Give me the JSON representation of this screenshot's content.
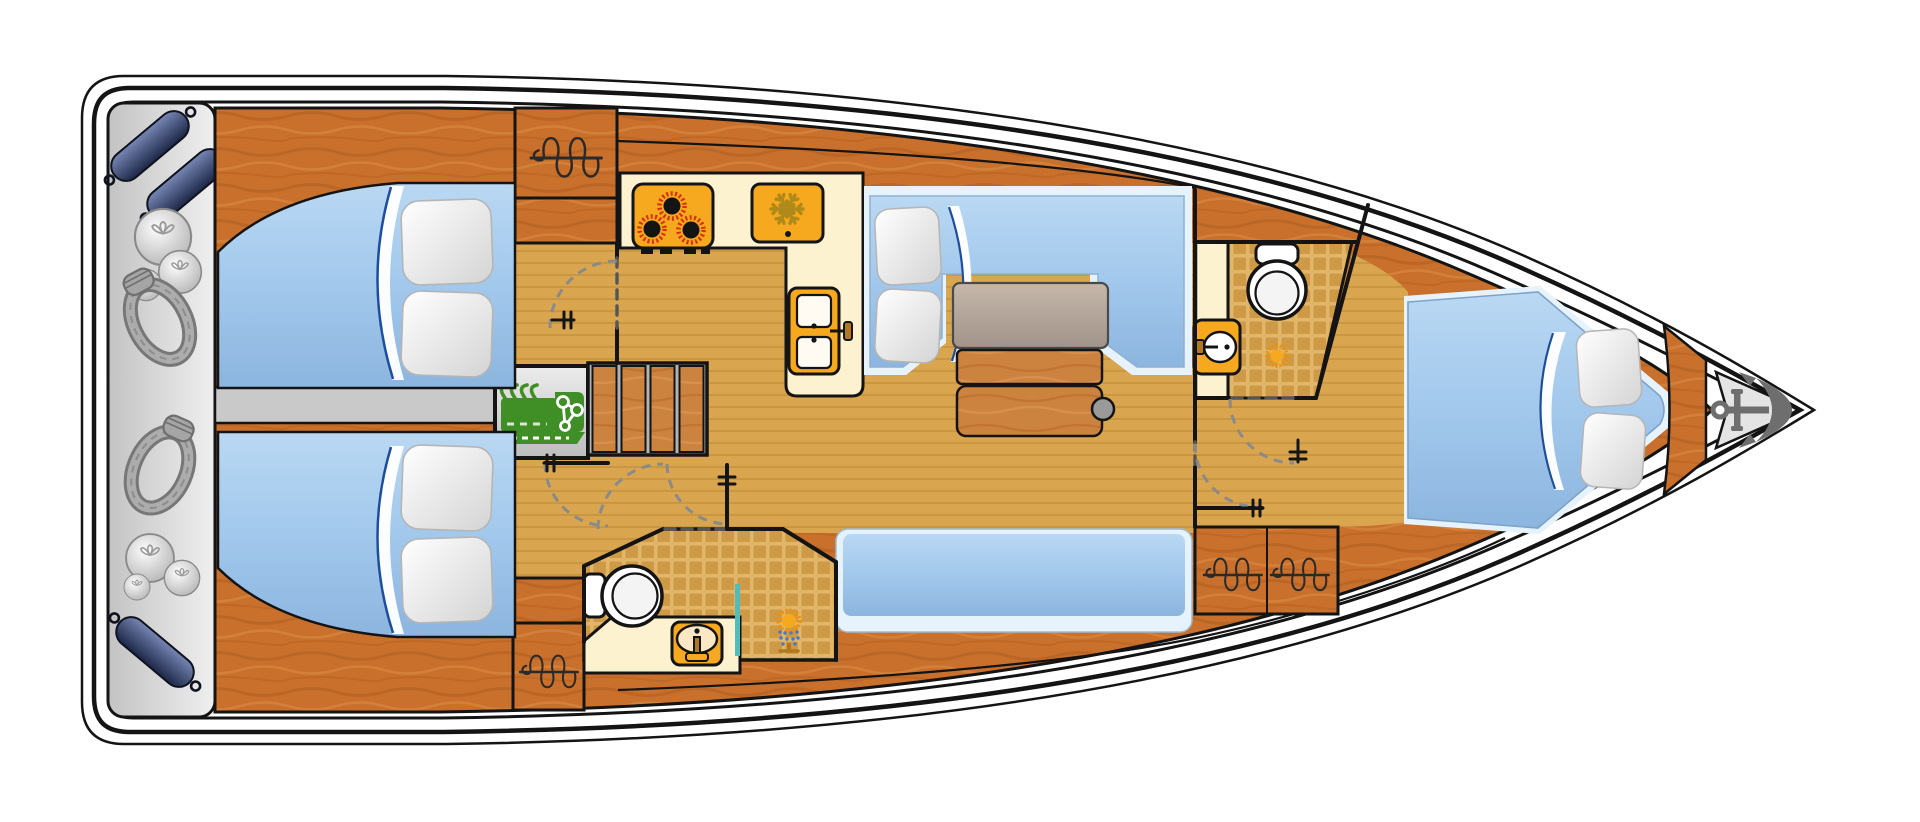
{
  "diagram": {
    "type": "sailing-yacht-interior-floor-plan",
    "view": "top-down",
    "orientation": "bow-right-stern-left",
    "cabins_visible": 3,
    "heads_visible": 2,
    "hatch_symbols_visible": 4
  },
  "palette": {
    "ink": "#141414",
    "hull-white": "#ffffff",
    "stern-deck-gray": "#d6d6d6",
    "wood": "#c8702c",
    "floor-tan": "#d9a54e",
    "tile-grout": "#e2b66a",
    "tile-cell": "#cf9a45",
    "cream": "#fdf2d0",
    "orange": "#f6a81f",
    "burner": "#d63000",
    "snow": "#b08a18",
    "bed-blue": "#a2c8ec",
    "bed-accent": "#1d4e9e",
    "seat-trim": "#e6f3fc",
    "pillow": "#f5f5f5",
    "table-leaf": "#b3a294",
    "knob": "#9a9a9a",
    "engine-green": "#3f8f26",
    "gray-strip": "#c9c9c9",
    "fender-navy": "#2e3b63",
    "rope-gray": "#a0a0a0",
    "anchor": "#6e6e6e",
    "teal": "#52bdb8",
    "door-dash": "#8a8a8a"
  },
  "icons": [
    {
      "name": "stove-icon",
      "glyph": "3 burners"
    },
    {
      "name": "fridge-icon",
      "glyph": "snowflake"
    },
    {
      "name": "galley-sink-icon",
      "glyph": "double basin + faucet"
    },
    {
      "name": "toilet-icon",
      "glyph": "bowl + tank"
    },
    {
      "name": "bathroom-sink-icon",
      "glyph": "oval basin + faucet"
    },
    {
      "name": "shower-icon",
      "glyph": "spray head"
    },
    {
      "name": "drain-icon",
      "glyph": "sun burst"
    },
    {
      "name": "engine-icon",
      "glyph": "green engine block"
    },
    {
      "name": "hatch-icon",
      "glyph": "coil over line"
    },
    {
      "name": "door-handle-icon",
      "glyph": "pronged handle"
    },
    {
      "name": "door-swing-arc",
      "glyph": "dashed quarter circle"
    },
    {
      "name": "anchor-icon",
      "glyph": "anchor"
    },
    {
      "name": "fender-icon",
      "glyph": "navy capsule"
    },
    {
      "name": "ball-fender-icon",
      "glyph": "gray sphere"
    },
    {
      "name": "rope-coil-icon",
      "glyph": "coiled line"
    }
  ]
}
